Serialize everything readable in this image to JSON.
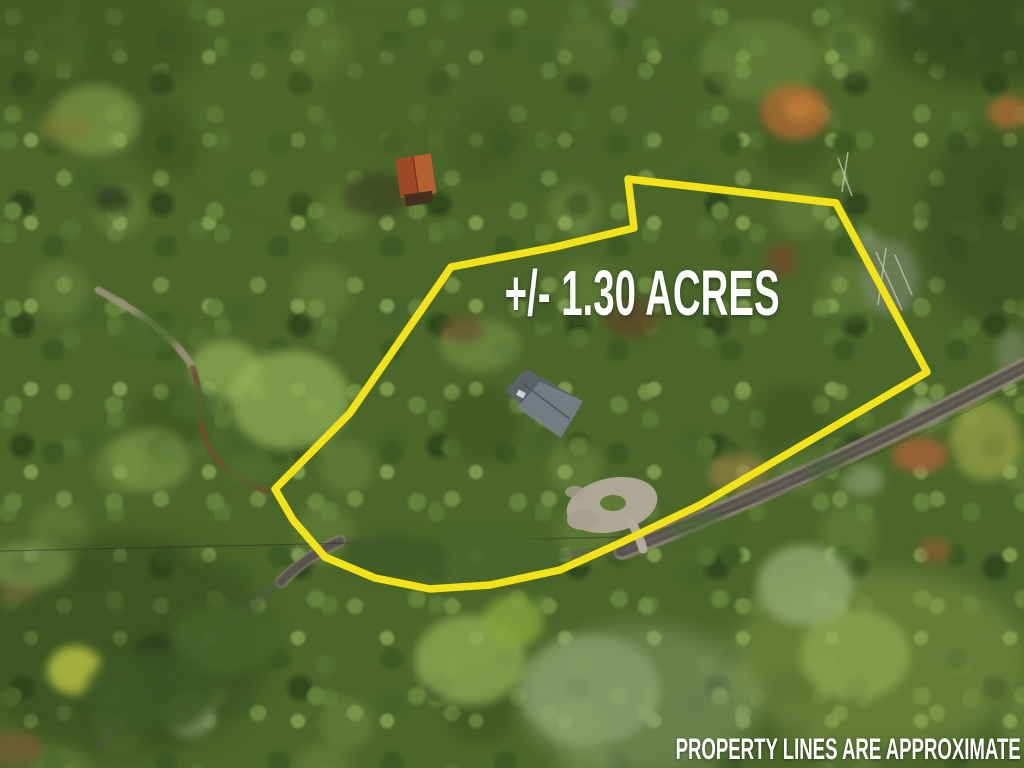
{
  "image": {
    "acreage_label": "+/- 1.30 ACRES",
    "disclaimer": "PROPERTY LINES ARE APPROXIMATE",
    "text_color": "#ffffff",
    "boundary": {
      "color": "#f2e218",
      "points": "628,179 836,203 927,372 700,505 620,543 560,570 490,585 430,589 375,578 325,557 293,520 275,489 350,413 451,267 555,247 634,228"
    }
  }
}
